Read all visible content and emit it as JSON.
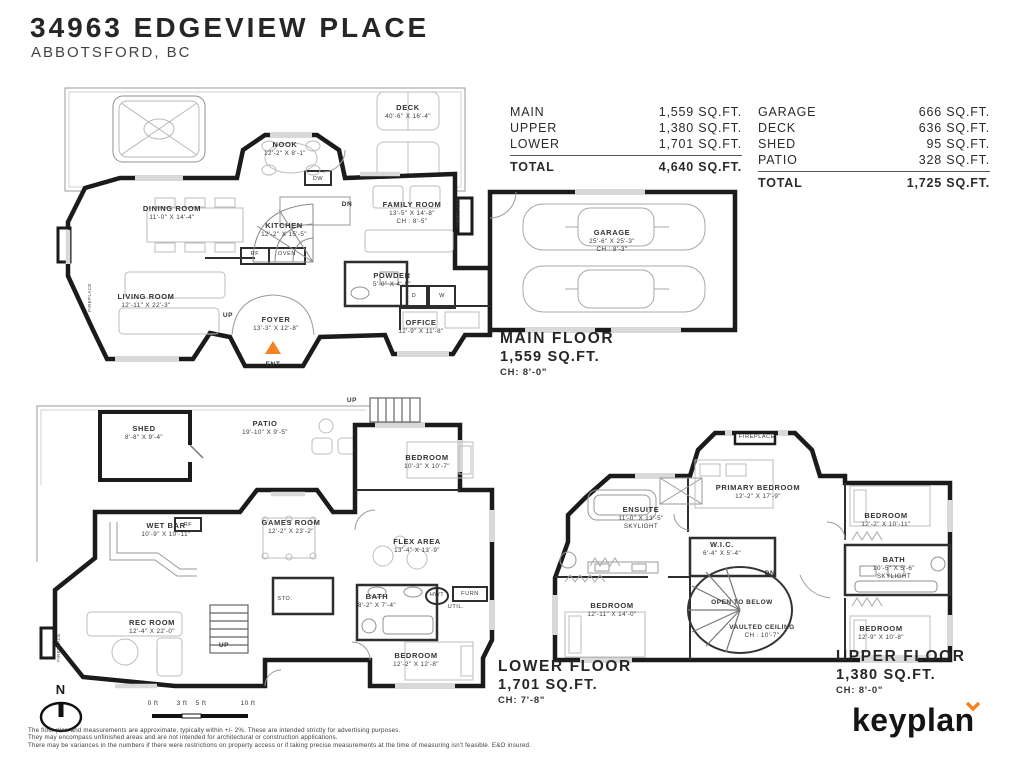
{
  "header": {
    "title": "34963 EDGEVIEW PLACE",
    "subtitle": "ABBOTSFORD, BC"
  },
  "area_table": {
    "left": {
      "rows": [
        {
          "label": "MAIN",
          "value": "1,559 SQ.FT."
        },
        {
          "label": "UPPER",
          "value": "1,380 SQ.FT."
        },
        {
          "label": "LOWER",
          "value": "1,701 SQ.FT."
        }
      ],
      "total": {
        "label": "TOTAL",
        "value": "4,640 SQ.FT."
      }
    },
    "right": {
      "rows": [
        {
          "label": "GARAGE",
          "value": "666 SQ.FT."
        },
        {
          "label": "DECK",
          "value": "636 SQ.FT."
        },
        {
          "label": "SHED",
          "value": "95 SQ.FT."
        },
        {
          "label": "PATIO",
          "value": "328 SQ.FT."
        }
      ],
      "total": {
        "label": "TOTAL",
        "value": "1,725 SQ.FT."
      }
    }
  },
  "floor_labels": {
    "main": {
      "name": "MAIN FLOOR",
      "area": "1,559 SQ.FT.",
      "ch": "CH: 8'-0\""
    },
    "lower": {
      "name": "LOWER FLOOR",
      "area": "1,701 SQ.FT.",
      "ch": "CH: 7'-8\""
    },
    "upper": {
      "name": "UPPER FLOOR",
      "area": "1,380 SQ.FT.",
      "ch": "CH: 8'-0\""
    }
  },
  "rooms": {
    "deck": {
      "name": "DECK",
      "dims": "40'-6\" X 16'-4\""
    },
    "nook": {
      "name": "NOOK",
      "dims": "12'-2\" X 8'-1\""
    },
    "dining": {
      "name": "DINING ROOM",
      "dims": "11'-0\" X 14'-4\""
    },
    "kitchen": {
      "name": "KITCHEN",
      "dims": "12'-2\" X 15'-5\""
    },
    "family": {
      "name": "FAMILY ROOM",
      "dims": "13'-5\" X 14'-8\"",
      "extra": "CH : 8'-5\""
    },
    "living": {
      "name": "LIVING ROOM",
      "dims": "12'-11\" X 22'-3\""
    },
    "powder": {
      "name": "POWDER",
      "dims": "5'-0\" X 4'-8\""
    },
    "foyer": {
      "name": "FOYER",
      "dims": "13'-3\" X 12'-8\""
    },
    "office": {
      "name": "OFFICE",
      "dims": "12'-9\" X 11'-8\""
    },
    "garage": {
      "name": "GARAGE",
      "dims": "25'-6\" X 25'-3\"",
      "extra": "CH : 8'-3\""
    },
    "shed": {
      "name": "SHED",
      "dims": "8'-8\" X 9'-4\""
    },
    "patio": {
      "name": "PATIO",
      "dims": "19'-10\" X 9'-5\""
    },
    "bedroom_l1": {
      "name": "BEDROOM",
      "dims": "10'-3\" X 10'-7\""
    },
    "wetbar": {
      "name": "WET BAR",
      "dims": "10'-9\" X 10'-11\""
    },
    "games": {
      "name": "GAMES ROOM",
      "dims": "12'-2\" X 23'-2\""
    },
    "flex": {
      "name": "FLEX AREA",
      "dims": "13'-4\" X 13'-9\""
    },
    "bath_l": {
      "name": "BATH",
      "dims": "8'-2\" X 7'-4\""
    },
    "rec": {
      "name": "REC ROOM",
      "dims": "12'-4\" X 22'-0\""
    },
    "bedroom_l2": {
      "name": "BEDROOM",
      "dims": "12'-2\" X 12'-8\""
    },
    "primary": {
      "name": "PRIMARY BEDROOM",
      "dims": "12'-2\" X 17'-9\""
    },
    "ensuite": {
      "name": "ENSUITE",
      "dims": "11'-0\" X 13'-5\"",
      "extra": "SKYLIGHT"
    },
    "bedroom_u1": {
      "name": "BEDROOM",
      "dims": "12'-2\" X 10'-11\""
    },
    "wic": {
      "name": "W.I.C.",
      "dims": "6'-4\" X 5'-4\""
    },
    "bath_u": {
      "name": "BATH",
      "dims": "10'-5\" X 5'-6\"",
      "extra": "SKYLIGHT"
    },
    "bedroom_u2": {
      "name": "BEDROOM",
      "dims": "12'-11\" X 14'-0\""
    },
    "open_below": {
      "name": "OPEN TO BELOW"
    },
    "vaulted": {
      "name": "VAULTED CEILING",
      "dims": "CH : 10'-7\""
    },
    "bedroom_u3": {
      "name": "BEDROOM",
      "dims": "12'-9\" X 10'-8\""
    }
  },
  "markers": {
    "up": "UP",
    "dn": "DN",
    "ent": "ENT",
    "rf": "RF",
    "oven": "OVEN",
    "dw": "DW",
    "d": "D",
    "w": "W",
    "sto": "STO.",
    "util": "UTIL.",
    "hwt": "HWT",
    "furn": "FURN",
    "fireplace": "FIREPLACE"
  },
  "scale_bar": {
    "labels": [
      "0 ft",
      "3 ft",
      "5 ft",
      "10 ft"
    ]
  },
  "compass": {
    "label": "N"
  },
  "disclaimer": {
    "line1": "The floor plan and measurements are approximate, typically within +/- 2%. These are intended strictly for advertising purposes.",
    "line2": "They may encompass unfinished areas and are not intended for architectural or construction applications.",
    "line3": "There may be variances in the numbers if there were restrictions on property access or if taking precise measurements at the time of measuring isn't feasible. E&O insured."
  },
  "logo": {
    "text": "keyplan",
    "accent_color": "#f6821f"
  }
}
